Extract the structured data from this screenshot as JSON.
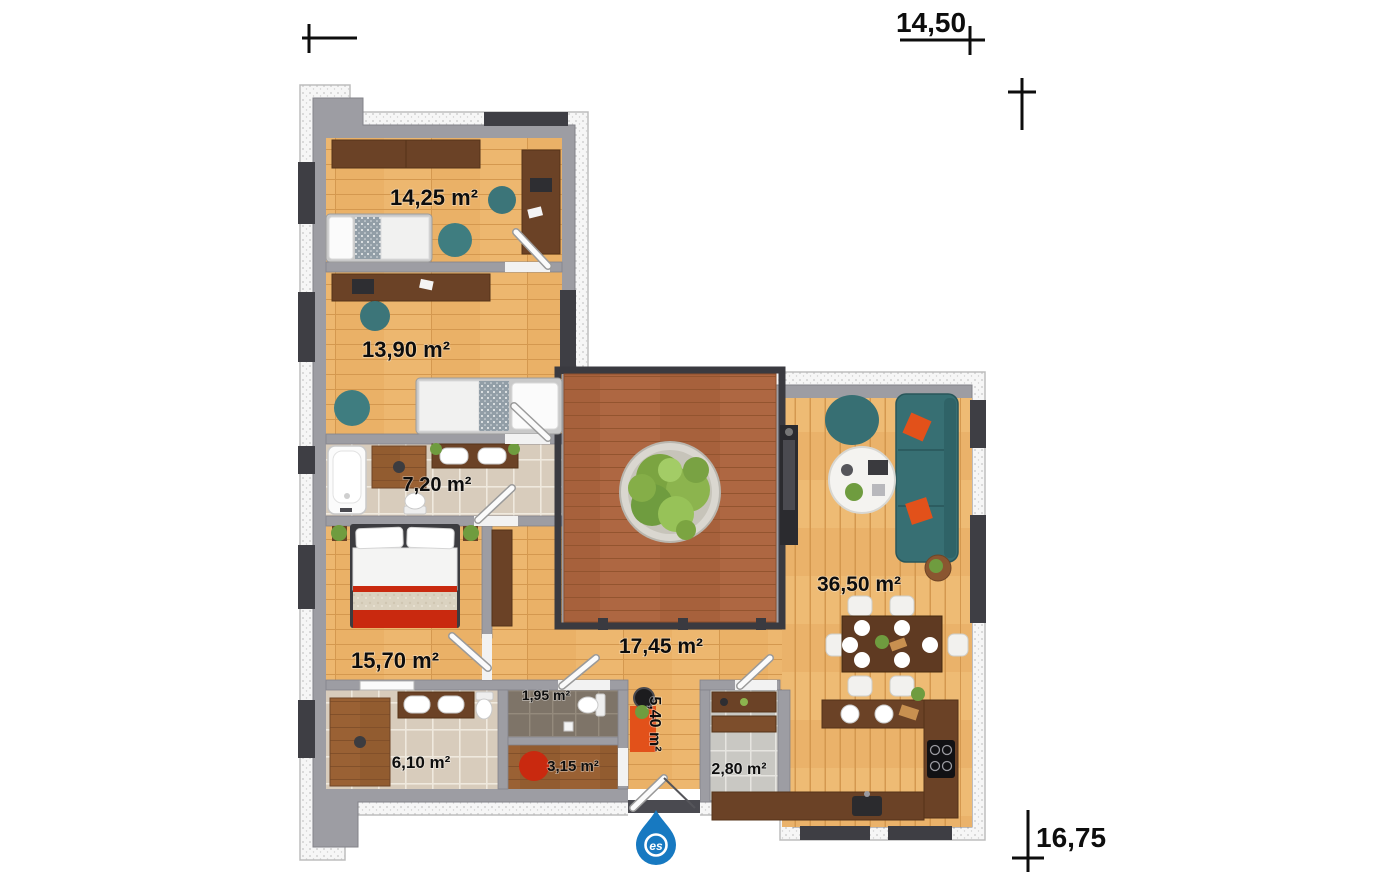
{
  "plan_type": "residential-floor-plan",
  "dimensions": {
    "width": "14,50",
    "height": "16,75"
  },
  "rooms": [
    {
      "name": "bedroom-1",
      "area_label": "14,25 m²"
    },
    {
      "name": "bedroom-2",
      "area_label": "13,90 m²"
    },
    {
      "name": "bathroom-main",
      "area_label": "7,20 m²"
    },
    {
      "name": "master-bedroom",
      "area_label": "15,70 m²"
    },
    {
      "name": "hallway",
      "area_label": "17,45 m²"
    },
    {
      "name": "living-dining",
      "area_label": "36,50 m²"
    },
    {
      "name": "bathroom-2",
      "area_label": "6,10 m²"
    },
    {
      "name": "wc",
      "area_label": "1,95 m²"
    },
    {
      "name": "wardrobe-room",
      "area_label": "3,15 m²"
    },
    {
      "name": "entry-hall",
      "area_label": "5,40 m²"
    },
    {
      "name": "pantry",
      "area_label": "2,80 m²"
    }
  ],
  "logo": {
    "initials": "es",
    "color": "#1779c1"
  },
  "colors": {
    "wood_light": "#edb76f",
    "wood_dark_furniture": "#6b4226",
    "deck": "#ae6742",
    "wall": "#9d9da3",
    "teal": "#376f73",
    "accent_red": "#c9290f",
    "accent_orange": "#e2511a",
    "tile_beige": "#d8ccbc",
    "tile_gray": "#c9c8c3",
    "logo_blue": "#1779c1"
  }
}
